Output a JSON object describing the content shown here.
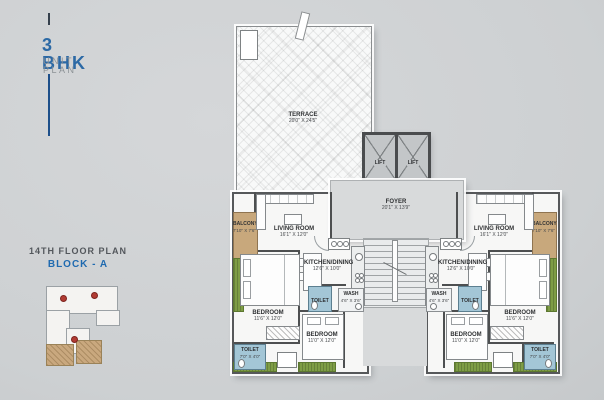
{
  "title": {
    "main": "3 BHK",
    "sub": "UNIT PLAN"
  },
  "floor_info": {
    "line1": "14TH FLOOR PLAN",
    "line2": "BLOCK - A"
  },
  "colors": {
    "accent_blue": "#2c69a5",
    "navy_line": "#1d4f8a",
    "balcony_tan": "#c8a87c",
    "planter_green": "#7e9d45",
    "toilet_blue": "#a3c6d6",
    "key_marker_red": "#b13b33",
    "background_gray": "#cdd0d2"
  },
  "plan": {
    "terrace": {
      "name": "TERRACE",
      "dim": "20'0\" X 24'5\""
    },
    "lift": {
      "name": "LIFT"
    },
    "foyer": {
      "name": "FOYER",
      "dim": "20'1\" X 13'9\""
    }
  },
  "rooms": {
    "living": {
      "name": "LIVING ROOM",
      "dim": "16'1\" X 12'0\""
    },
    "kitchen": {
      "name": "KITCHEN/DINING",
      "dim": "12'6\" X 10'0\""
    },
    "bedroom1": {
      "name": "BEDROOM",
      "dim": "11'6\" X 12'0\""
    },
    "bedroom2": {
      "name": "BEDROOM",
      "dim": "11'0\" X 12'0\""
    },
    "toilet": {
      "name": "TOILET",
      "dim": "7'0\" X 4'0\""
    },
    "wash": {
      "name": "WASH",
      "dim": "4'6\" X 3'6\""
    },
    "balcony": {
      "name": "BALCONY",
      "dim": "7'10\" X 7'6\""
    },
    "ots": {
      "name": "OTS"
    }
  }
}
